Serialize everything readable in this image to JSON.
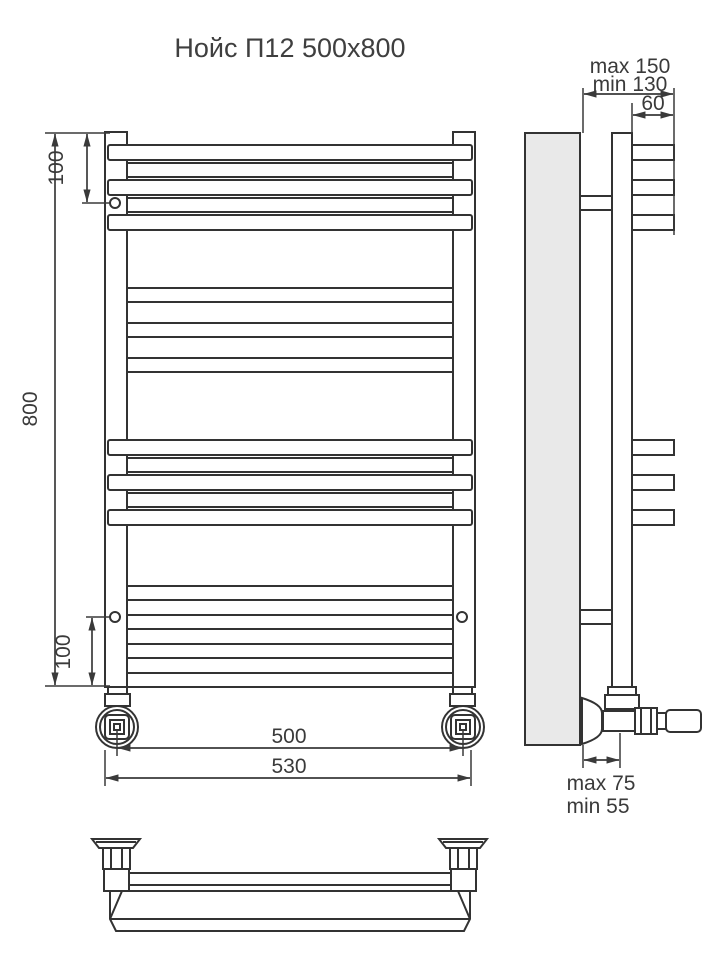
{
  "title": "Нойс П12 500x800",
  "front_view": {
    "dim_height": "800",
    "dim_offset_top": "100",
    "dim_offset_bottom": "100",
    "dim_pipe_spacing": "500",
    "dim_overall_width": "530"
  },
  "side_view": {
    "dim_wall_max": "max 150",
    "dim_wall_min": "min 130",
    "dim_rung_depth": "60",
    "dim_valve_max": "max 75",
    "dim_valve_min": "min 55"
  },
  "icons": {
    "bracket_mount": "circle-marker"
  },
  "colors": {
    "line": "#333333",
    "wall_fill": "#e9e9e9",
    "background": "#ffffff",
    "text": "#3a3a3a"
  }
}
